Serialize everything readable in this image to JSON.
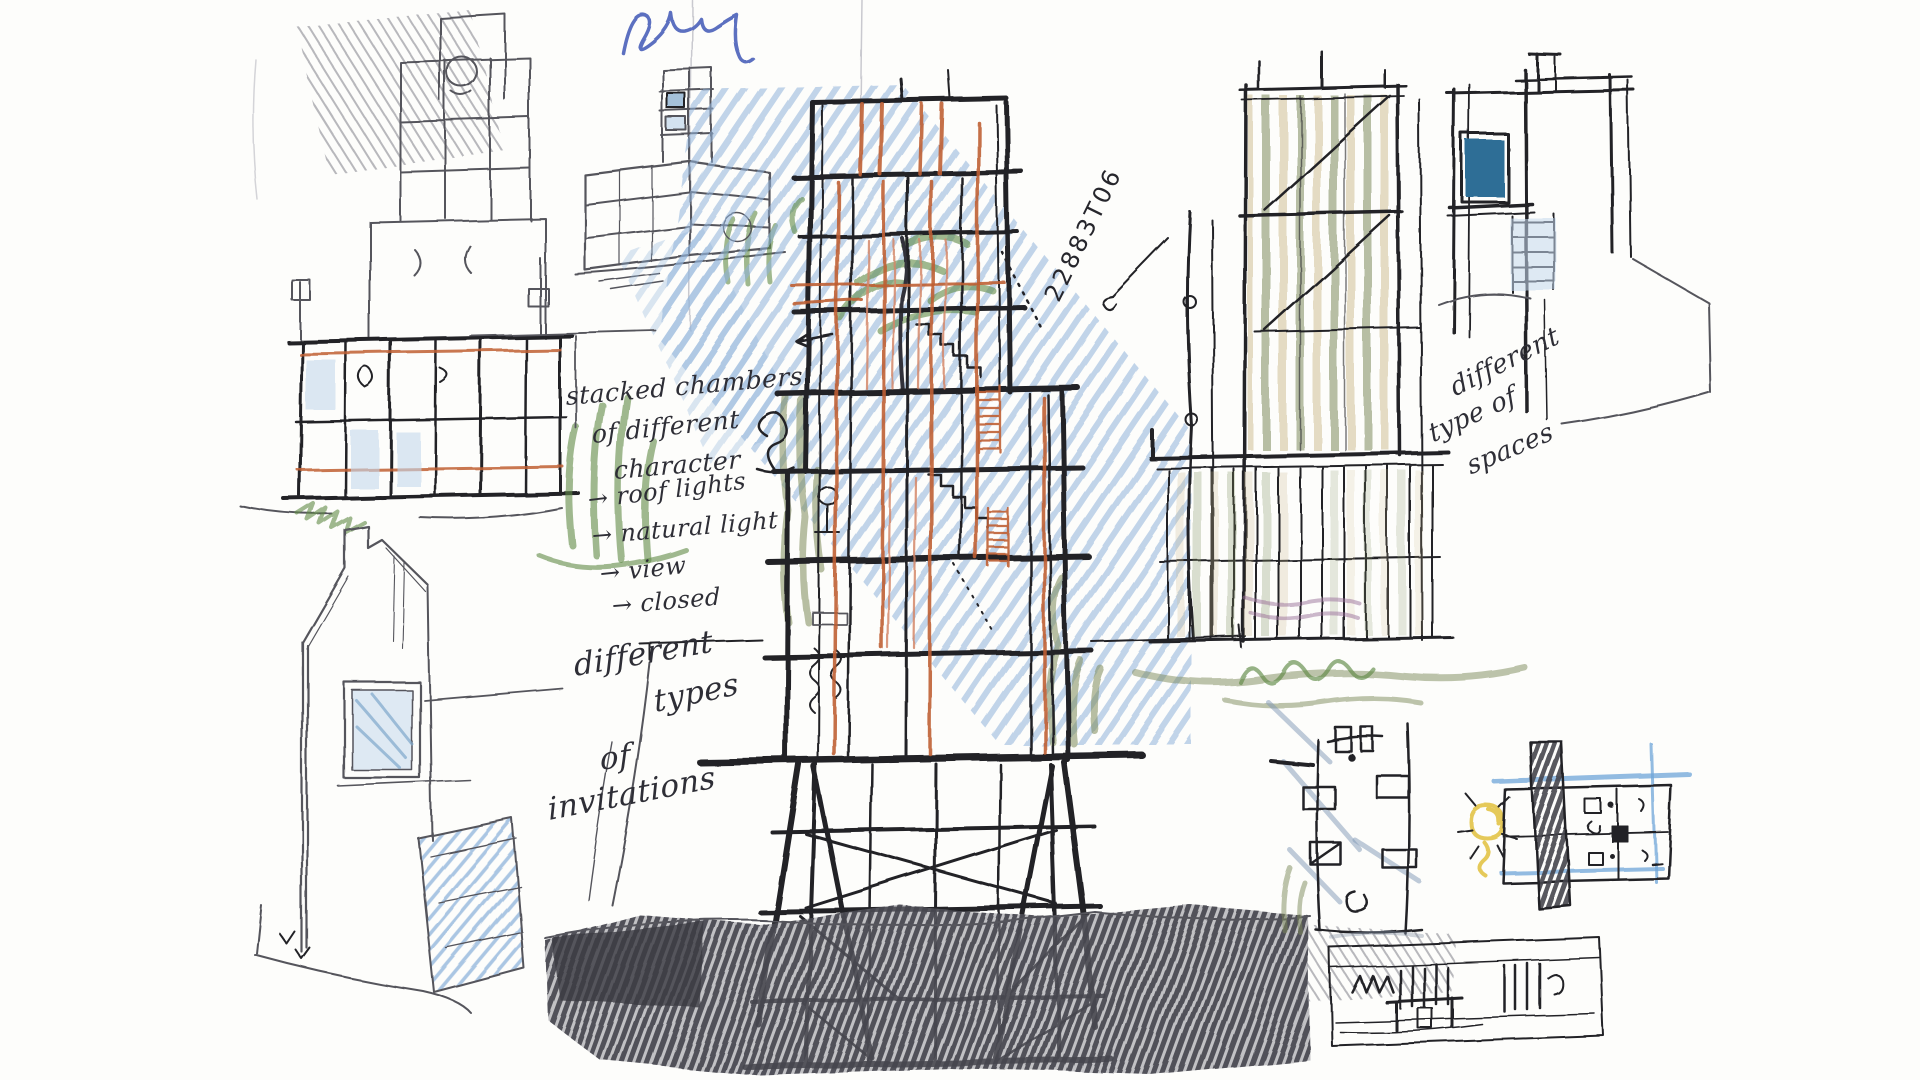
{
  "palette": {
    "paper": "#fdfdfb",
    "ink": "#232328",
    "pencil": "#55555c",
    "graphite": "#46464e",
    "blue_hatch": "#8fb3da",
    "blue_light": "#c5d9ec",
    "blue_deep": "#2f6e96",
    "blue_pen": "#5b6fc0",
    "bluegray": "#7f98b5",
    "orange": "#bf5f33",
    "salmon": "#d4876a",
    "green": "#5f8a46",
    "olive": "#7d8a5a",
    "tan": "#cbb98b",
    "yellow": "#e2c13d",
    "violet": "#9a6f9a"
  },
  "notes": {
    "arrow": "→",
    "chambers": {
      "l1": "stacked chambers",
      "l2": "of different",
      "l3": "character"
    },
    "arrows": {
      "i1": "roof lights",
      "i2": "natural light",
      "i3": "view",
      "i4": "closed"
    },
    "invitations": {
      "l1": "different",
      "l2": "types",
      "l3": "of",
      "l4": "invitations"
    },
    "spaces": {
      "l1": "different",
      "l2": "type of",
      "l3": "spaces"
    },
    "code": "22883T06"
  }
}
